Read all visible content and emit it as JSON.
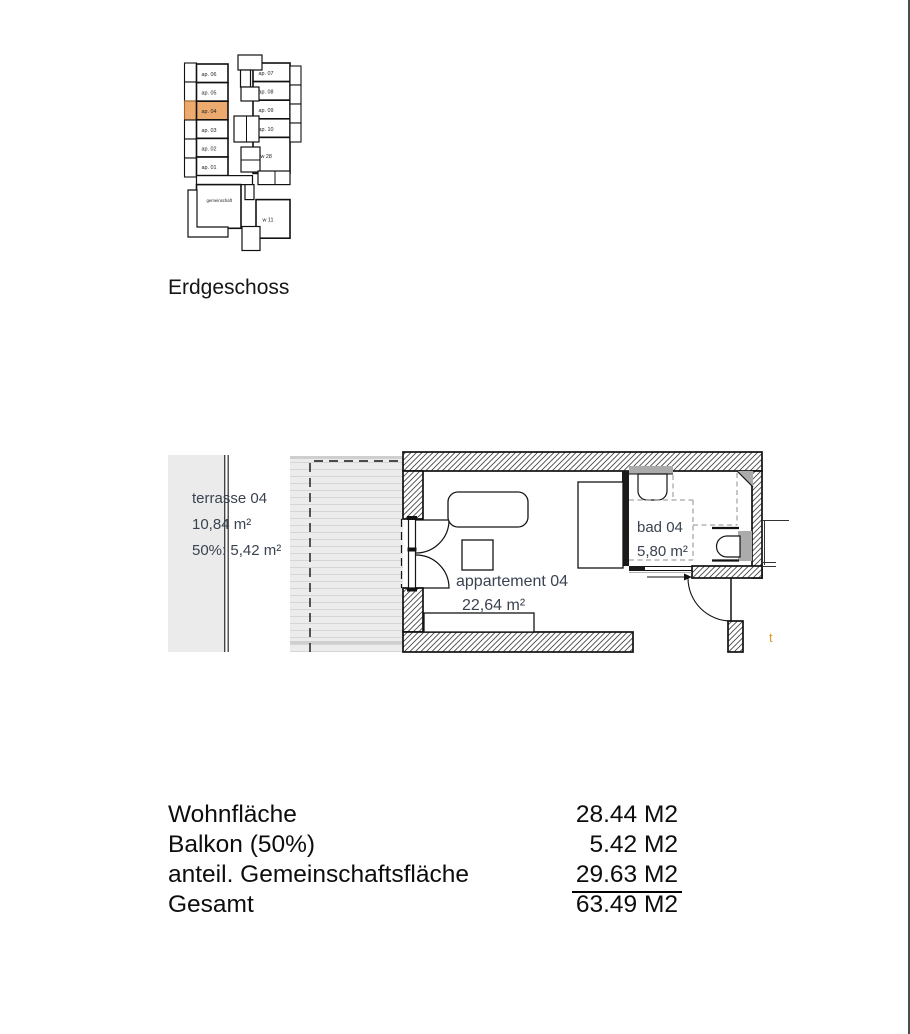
{
  "page": {
    "floor_title": "Erdgeschoss"
  },
  "site_map": {
    "highlighted_unit": "ap. 04",
    "highlight_color": "#ecaa6e",
    "left_units": [
      "ap. 06",
      "ap. 05",
      "ap. 04",
      "ap. 03",
      "ap. 02",
      "ap. 01"
    ],
    "right_units": [
      "ap. 07",
      "ap. 08",
      "ap. 09",
      "ap. 10",
      "w 28"
    ],
    "bottom_units": [
      "gemeinschaft",
      "w 11"
    ]
  },
  "floor_plan": {
    "label_color": "#3a4350",
    "terrace": {
      "name": "terrasse 04",
      "area": "10,84 m²",
      "half_area": "50%: 5,42 m²"
    },
    "apartment": {
      "name": "appartement 04",
      "area": "22,64 m²"
    },
    "bathroom": {
      "name": "bad 04",
      "area": "5,80 m²"
    },
    "edge_label": "t"
  },
  "summary": {
    "rows": [
      {
        "label": "Wohnfläche",
        "value": "28.44 M2"
      },
      {
        "label": "Balkon (50%)",
        "value": "5.42 M2"
      },
      {
        "label": "anteil. Gemeinschaftsfläche",
        "value": "29.63 M2"
      },
      {
        "label": "Gesamt",
        "value": "63.49 M2"
      }
    ]
  }
}
